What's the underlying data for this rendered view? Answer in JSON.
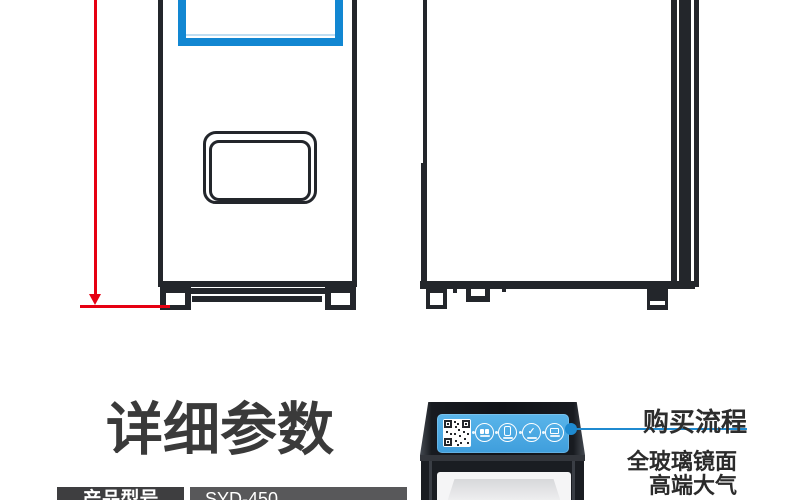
{
  "section": {
    "title": "详细参数"
  },
  "spec_table": {
    "rows": [
      {
        "label": "产品型号",
        "value": "SYD-450"
      }
    ]
  },
  "callouts": {
    "purchase_flow_label": "购买流程",
    "feature_line1": "全玻璃镜面",
    "feature_line2": "高端大气"
  },
  "sticker_icons": {
    "qr": "qr-code",
    "steps": [
      "scan-pay",
      "phone-order",
      "confirm-check",
      "pickup-goods"
    ]
  },
  "colors": {
    "drawing_line": "#23262b",
    "screen_blue": "#1287d2",
    "dimension_red": "#e60012",
    "callout_blue": "#1f8ad0",
    "sticker_blue": "#47aae4",
    "title_text": "#3a3a3a",
    "table_label_bg": "#3e3e40",
    "table_value_bg": "#58585a"
  }
}
